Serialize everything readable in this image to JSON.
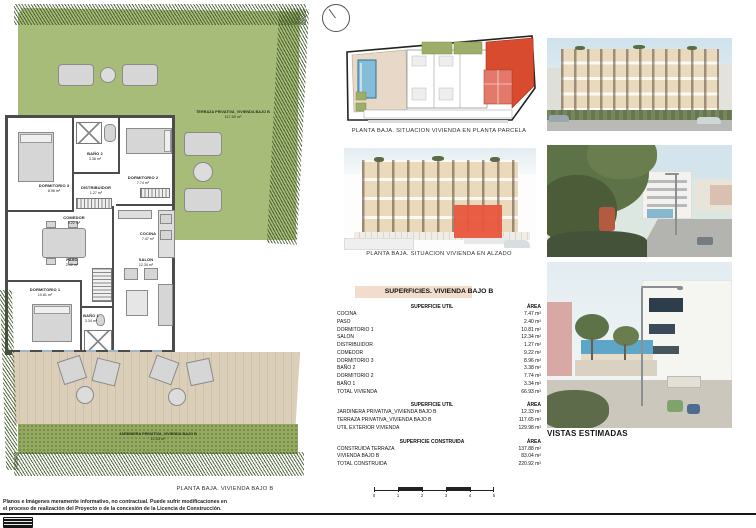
{
  "document": {
    "captions": {
      "site_plan": "PLANTA BAJA. SITUACION VIVIENDA EN PLANTA PARCELA",
      "elevation": "PLANTA BAJA. SITUACION VIVIENDA EN ALZADO",
      "floor_plan": "PLANTA BAJA. VIVIENDA BAJO B",
      "views_title": "VISTAS ESTIMADAS"
    },
    "disclaimer_line1": "Planos e Imágenes meramente informativo, no contractual. Puede sufrir modificaciones en",
    "disclaimer_line2": "el proceso de realización del Proyecto o de la concesión de la Licencia de Construcción."
  },
  "floor_plan": {
    "rooms": [
      {
        "name": "DORMITORIO 3",
        "area": "8.96 m²"
      },
      {
        "name": "BAÑO 2",
        "area": "3.38 m²"
      },
      {
        "name": "DORMITORIO 2",
        "area": "7.74 m²"
      },
      {
        "name": "DISTRIBUIDOR",
        "area": "1.27 m²"
      },
      {
        "name": "COMEDOR",
        "area": "9.22 m²"
      },
      {
        "name": "COCINA",
        "area": "7.47 m²"
      },
      {
        "name": "PASO",
        "area": "2.40 m²"
      },
      {
        "name": "DORMITORIO 1",
        "area": "10.81 m²"
      },
      {
        "name": "SALON",
        "area": "12.34 m²"
      },
      {
        "name": "BAÑO 1",
        "area": "3.34 m²"
      }
    ],
    "terraza_label": "TERRAZA PRIVATIVA_VIVIENDA BAJO B",
    "terraza_area": "117.65 m²",
    "jardinera_label": "JARDINERA PRIVATIVA_VIVIENDA BAJO B",
    "jardinera_area": "12.33 m²"
  },
  "surfaces_table": {
    "title": "SUPERFICIES. VIVIENDA BAJO B",
    "sections": [
      {
        "header": "SUPERFICIE UTIL",
        "area_header": "ÁREA",
        "rows": [
          {
            "label": "COCINA",
            "value": "7.47 m²"
          },
          {
            "label": "PASO",
            "value": "2.40 m²"
          },
          {
            "label": "DORMITORIO 1",
            "value": "10.81 m²"
          },
          {
            "label": "SALON",
            "value": "12.34 m²"
          },
          {
            "label": "DISTRIBUIDOR",
            "value": "1.27 m²"
          },
          {
            "label": "COMEDOR",
            "value": "9.22 m²"
          },
          {
            "label": "DORMITORIO 3",
            "value": "8.96 m²"
          },
          {
            "label": "BAÑO 2",
            "value": "3.38 m²"
          },
          {
            "label": "DORMITORIO 2",
            "value": "7.74 m²"
          },
          {
            "label": "BAÑO 1",
            "value": "3.34 m²"
          },
          {
            "label": "TOTAL VIVIENDA",
            "value": "66.93 m²"
          }
        ]
      },
      {
        "header": "SUPERFICIE UTIL",
        "area_header": "ÁREA",
        "rows": [
          {
            "label": "JARDINERA PRIVATIVA_VIVIENDA BAJO B",
            "value": "12.33 m²"
          },
          {
            "label": "TERRAZA PRIVATIVA_VIVIENDA BAJO B",
            "value": "117.65 m²"
          },
          {
            "label": "UTIL EXTERIOR VIVIENDA",
            "value": "129.98 m²"
          }
        ]
      },
      {
        "header": "SUPERFICIE CONSTRUIDA",
        "area_header": "ÁREA",
        "rows": [
          {
            "label": "CONSTRUIDA TERRAZA",
            "value": "137.88 m²"
          },
          {
            "label": "VIVIENDA BAJO B",
            "value": "83.04 m²"
          },
          {
            "label": "TOTAL CONSTRUIDA",
            "value": "220.92 m²"
          }
        ]
      }
    ]
  },
  "scale_bar": {
    "labels": [
      "0",
      "1",
      "2",
      "3",
      "4",
      "5"
    ]
  },
  "icons": {
    "north_arrow": "circle-with-needle"
  },
  "colors": {
    "garden_green": "#a8bc79",
    "hatch_green": "#3e5426",
    "deck_beige": "#d9cdb9",
    "highlight_red": "#d84b2e",
    "pool_blue": "#85bdd9",
    "table_highlight": "#f2dccb"
  }
}
